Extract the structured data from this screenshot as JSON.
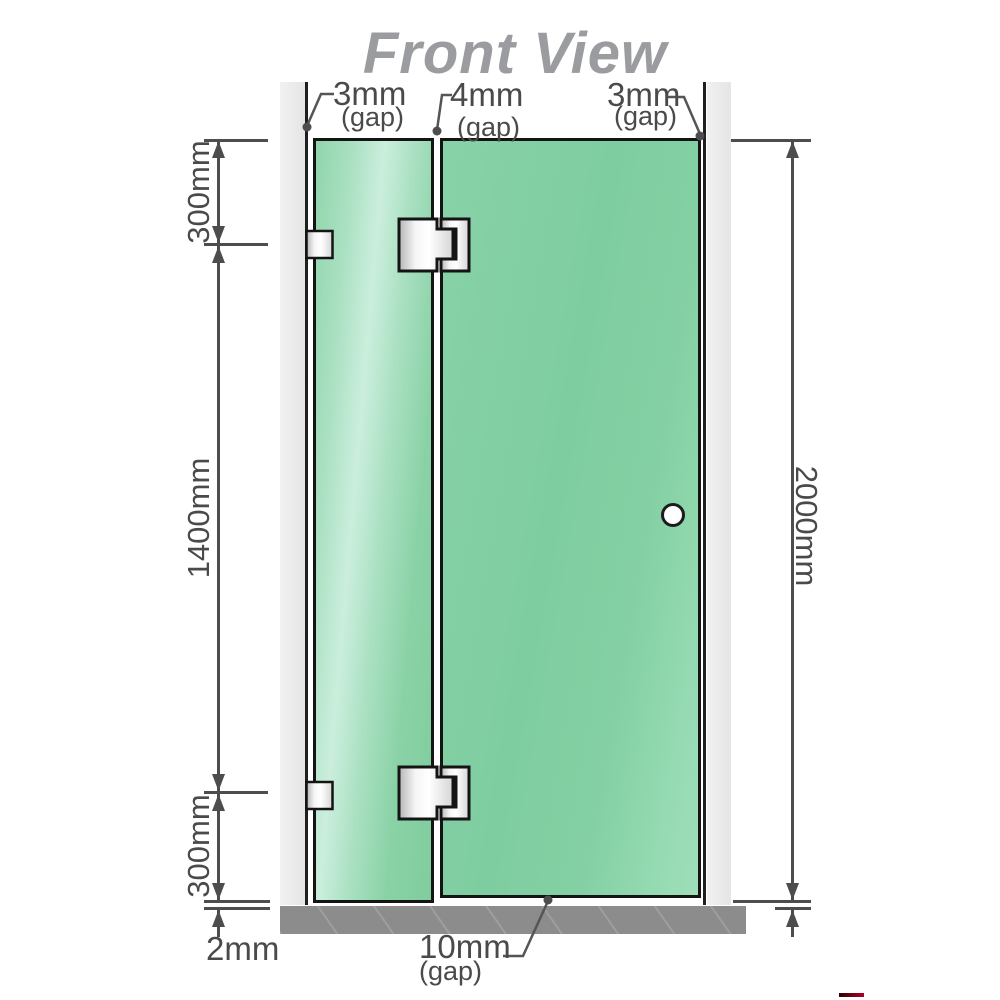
{
  "title": "Front View",
  "annotations": {
    "gap_top_left": {
      "value": "3mm",
      "note": "(gap)"
    },
    "gap_top_middle": {
      "value": "4mm",
      "note": "(gap)"
    },
    "gap_top_right": {
      "value": "3mm",
      "note": "(gap)"
    },
    "gap_bottom_door": {
      "value": "10mm",
      "note": "(gap)"
    },
    "gap_bottom_floor": {
      "value": "2mm"
    }
  },
  "dimensions": {
    "left_top": "300mm",
    "left_middle": "1400mm",
    "left_bottom": "300mm",
    "right_total": "2000mm"
  },
  "colors": {
    "glass": "#85d0a4",
    "glass_highlight": "#cbeedd",
    "wall": "#e9e9e9",
    "panel_outline": "#141414",
    "floor": "#8c8c8c",
    "dimension_line": "#4d4d4d",
    "label_text": "#4a4a4a",
    "title_text": "#9b9c9f",
    "handle": "#ffffff",
    "accent_red": "#b00022"
  }
}
